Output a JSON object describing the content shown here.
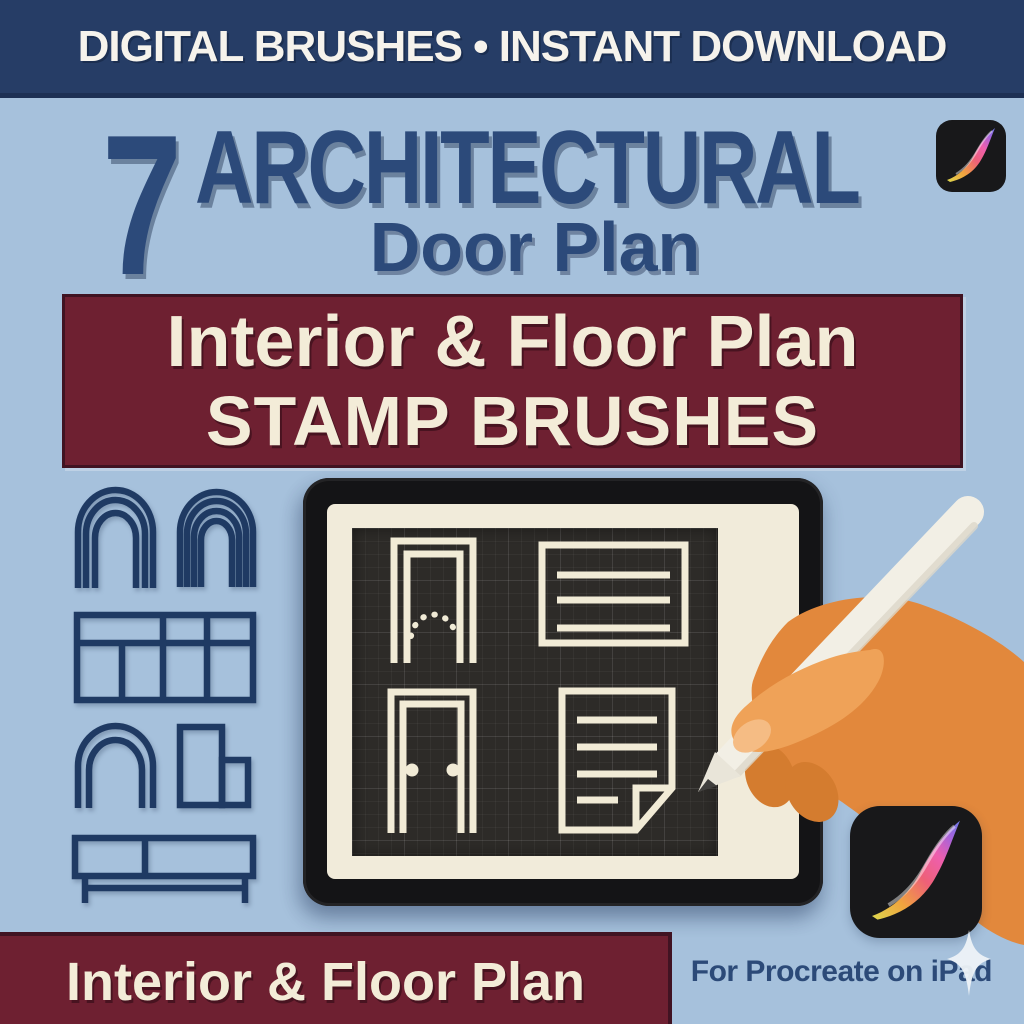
{
  "poster": {
    "top_banner": {
      "text": "DIGITAL BRUSHES • INSTANT DOWNLOAD"
    },
    "title": {
      "count": "7",
      "main": "ARCHITECTURAL",
      "sub": "Door Plan"
    },
    "ribbon": {
      "line1": "Interior & Floor Plan",
      "line2": "STAMP BRUSHES"
    },
    "bottom_ribbon": {
      "text": "Interior & Floor Plan"
    },
    "footer": {
      "text": "For Procreate on iPad"
    }
  },
  "colors": {
    "background": "#a6c1dc",
    "banner_navy": "#263d66",
    "title_navy": "#2c4a7a",
    "ribbon_maroon": "#6e2031",
    "cream_text": "#f3ecd8",
    "tablet_black": "#141416",
    "bezel_cream": "#f1ebda",
    "canvas_charcoal": "#2d2b28",
    "stamp_cream": "#f1ebd6",
    "hand_orange": "#e2883c",
    "stylus_white": "#f2efe5"
  },
  "icons": {
    "procreate_top": "procreate-app-icon",
    "procreate_bottom": "procreate-app-icon",
    "sparkle": "sparkle-icon",
    "stylus": "apple-pencil-stylus",
    "hand": "hand-holding-stylus",
    "left_column_stamps": [
      "double-arch-window-stamp",
      "triple-arch-window-stamp",
      "cabinet-grid-stamp",
      "arched-door-stamp",
      "corner-cabinet-stamp",
      "console-table-stamp"
    ],
    "canvas_stamps": [
      "arched-door-swing-stamp",
      "wall-panel-stamp",
      "door-elevation-stamp",
      "plan-sheet-stamp"
    ]
  }
}
